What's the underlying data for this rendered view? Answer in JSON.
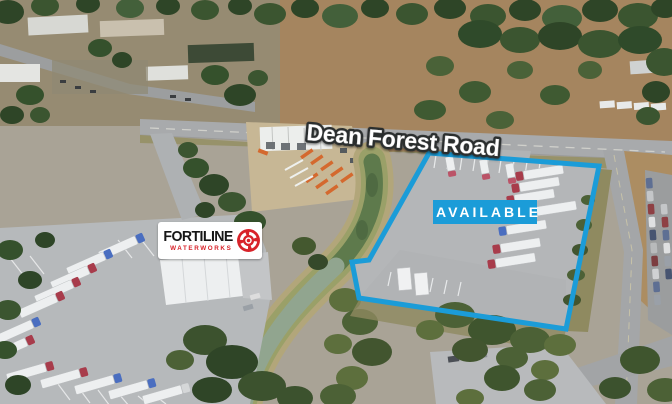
{
  "annotations": {
    "road_label": "Dean Forest Road",
    "available_badge": "AVAILABLE"
  },
  "logo": {
    "title": "FORTILINE",
    "subtitle": "WATERWORKS",
    "emblem_icon": "fortiline-emblem-icon"
  },
  "colors": {
    "accent_blue": "#1b9cd8",
    "logo_red": "#d8232a",
    "label_fill": "#ffffff",
    "label_outline": "#2b2d2f"
  }
}
